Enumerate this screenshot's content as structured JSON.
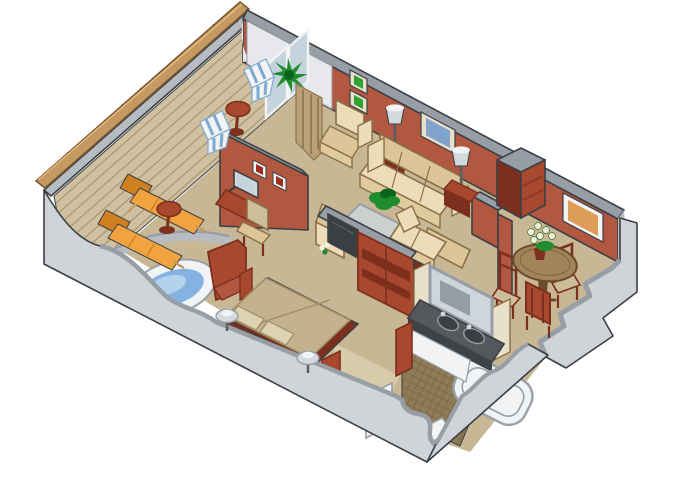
{
  "figure": {
    "type": "isometric-cutaway-floor-plan",
    "subject": "cruise-ship suite with private veranda",
    "background": "#ffffff"
  },
  "palette": {
    "bg": "#ffffff",
    "outer-wall": "#d0d3d8",
    "outer-wall-dark": "#b7bcc3",
    "wall-cap": "#989ea6",
    "wall-line": "#3c4045",
    "red-wall": "#b25740",
    "red-wall-dark": "#8c3a28",
    "red-wood": "#a8492f",
    "red-wood-dark": "#7c2f1c",
    "carpet": "#c7b795",
    "carpet-light": "#d8cbaa",
    "deck": "#cfc0a0",
    "deck-line": "#a3926f",
    "wood-rail": "#c49a62",
    "wood-rail-dark": "#7a5530",
    "wood-rail-light": "#e4bc80",
    "lounger": "#f0a33e",
    "lounger-dark": "#d07f1f",
    "stripe-blue": "#7fa9d0",
    "water-blue": "#85b3e1",
    "water-light": "#b3d2ee",
    "porcelain": "#f1f3f5",
    "porcelain-line": "#9aa0a6",
    "cream-sofa": "#ecdcba",
    "cream-sofa-dark": "#dcc697",
    "cream-skirt": "#e0caa0",
    "cream-line": "#8a6f46",
    "glass": "#c5d3dc",
    "mirror": "#cdd6da",
    "lamp-shade": "#d4d9dd",
    "lamp-stem": "#5a5f65",
    "counter": "#55595e",
    "counter-dark": "#3f4347",
    "tv": "#3a3f44",
    "tile": "#8f7c58",
    "tile-line": "#6e5c3e",
    "table-wood": "#a2835a",
    "table-wood-dark": "#6b4c2c",
    "plant": "#1f8c2d",
    "plant-dark": "#0c641a",
    "pic-green": "#2fa233",
    "pic-blue": "#7fa3cc",
    "pic-orange": "#dd9c58",
    "pic-red": "#9c2d20",
    "frame-cream": "#e8e0c8",
    "frame-white": "#f2f3f4",
    "flower-white": "#f6f2dc",
    "drape": "#bca079",
    "drape-dark": "#8a7350",
    "seat-tan": "#cdbd9a",
    "bedspread": "#c3b28c",
    "bedspread-line": "#9d8d68",
    "pillow": "#ddd2b2",
    "entry-wall": "#e6e8eb"
  },
  "rooms": {
    "veranda": "veranda deck",
    "living": "living room",
    "dining": "dining area",
    "bedroom": "bedroom",
    "bathroom": "bathroom",
    "entry": "entry"
  },
  "inventory": {
    "veranda": [
      "sun-lounger",
      "sun-lounger",
      "cocktail-table",
      "deck-chair",
      "deck-chair",
      "cocktail-table",
      "potted-plant",
      "railing-with-wood-handrail"
    ],
    "living": [
      "armchair",
      "armchair",
      "sofa",
      "loveseat",
      "side-table-with-lamp",
      "side-table-with-lamp",
      "glass-coffee-table",
      "potted-plant",
      "corner-etagere",
      "framed-art-green",
      "framed-art-green",
      "framed-art-blue"
    ],
    "dining": [
      "round-pedestal-table",
      "dining-chair",
      "dining-chair",
      "dining-chair",
      "flower-vase",
      "framed-art-orange"
    ],
    "bedroom": [
      "double-bed",
      "headboard",
      "wall-sconce-lamp",
      "wall-sconce-lamp",
      "armchair-red",
      "whirlpool-tub",
      "media-cabinet-with-tv",
      "wardrobe",
      "desk-with-monitor",
      "desk-chair",
      "framed-art-red",
      "framed-art-red"
    ],
    "bathroom": [
      "double-sink-vanity",
      "mirror",
      "bathtub",
      "toilet",
      "shower-tray",
      "door",
      "mosaic-tile-floor"
    ],
    "entry": [
      "sliding-glass-doors",
      "drapes"
    ]
  }
}
